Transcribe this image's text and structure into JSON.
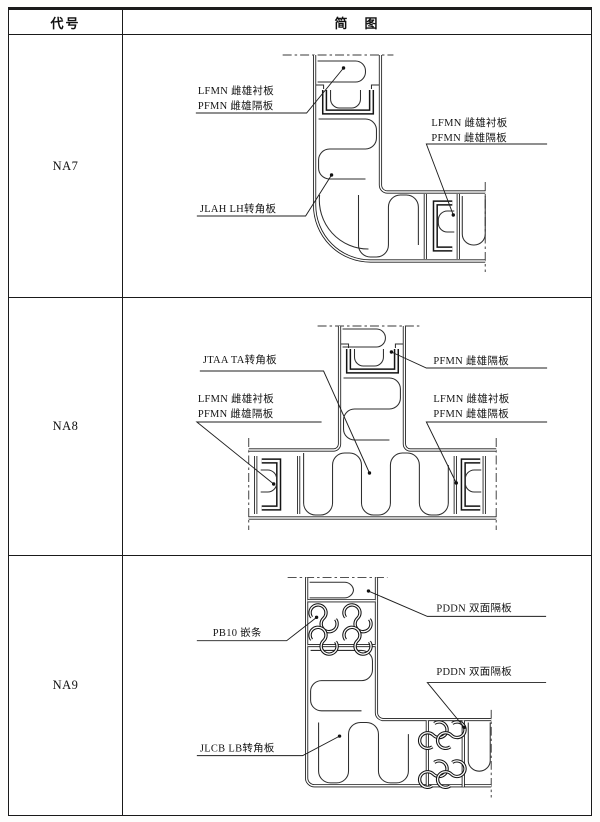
{
  "header": {
    "code_col": "代号",
    "diagram_col": "简　图"
  },
  "rows": [
    {
      "code": "NA7",
      "labels": {
        "left_1": "LFMN  雌雄衬板",
        "left_2": "PFMN  雌雄隔板",
        "right_1": "LFMN  雌雄衬板",
        "right_2": "PFMN  雌雄隔板",
        "corner": "JLAH  LH转角板"
      }
    },
    {
      "code": "NA8",
      "labels": {
        "corner": "JTAA  TA转角板",
        "left_1": "LFMN  雌雄衬板",
        "left_2": "PFMN  雌雄隔板",
        "right_top": "PFMN  雌雄隔板",
        "right_1": "LFMN  雌雄衬板",
        "right_2": "PFMN  雌雄隔板"
      }
    },
    {
      "code": "NA9",
      "labels": {
        "insert": "PB10  嵌条",
        "right_top": "PDDN  双面隔板",
        "right_mid": "PDDN  双面隔板",
        "corner": "JLCB  LB转角板"
      }
    }
  ],
  "colors": {
    "line": "#1b1b1b",
    "paper": "#ffffff"
  }
}
